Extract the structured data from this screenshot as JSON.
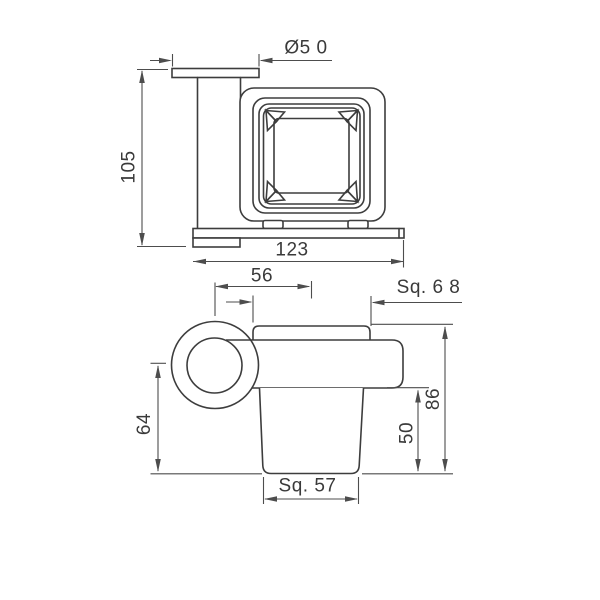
{
  "page": {
    "background_color": "#ffffff",
    "object_line_color": "#3d3d3d",
    "dimension_line_color": "#4d4d4d",
    "text_color": "#3a3a3a"
  },
  "drawing": {
    "type": "technical-orthographic-drawing",
    "subject": "wall-mounted square tumbler holder",
    "views": {
      "top_view": {
        "dimensions": {
          "flange_diameter": "Ø5 0",
          "depth": "105",
          "width": "123"
        }
      },
      "front_view": {
        "dimensions": {
          "center_offset": "56",
          "holder_square": "Sq. 6 8",
          "drop_height": "64",
          "cup_exposed_height": "50",
          "overall_height": "86",
          "cup_square": "Sq. 57"
        }
      }
    }
  }
}
